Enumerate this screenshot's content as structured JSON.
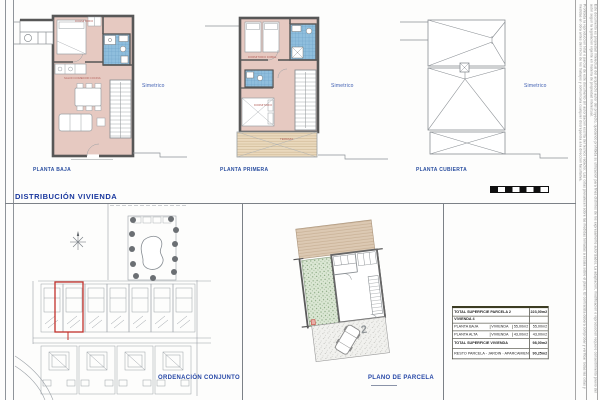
{
  "sheet": {
    "title": "DISTRIBUCIÓN  VIVIENDA",
    "plans": [
      {
        "label": "PLANTA BAJA",
        "note": "Simetrico"
      },
      {
        "label": "PLANTA PRIMERA",
        "note": "Simetrico"
      },
      {
        "label": "PLANTA CUBIERTA",
        "note": "Simetrico"
      }
    ],
    "room_labels": {
      "pb_bedroom": "DORMITORIO",
      "pb_living": "SALON COMEDOR COCINA",
      "p1_bedroom1": "DORMITORIO DOBLE",
      "p1_bedroom2": "DORMITORIO",
      "p1_terrace": "TERRAZA"
    },
    "panels": {
      "site_plan_label": "ORDENACIÓN CONJUNTO",
      "parcel_plan_label": "PLANO DE PARCELA",
      "parcel_number": "2"
    }
  },
  "table": {
    "rows": [
      {
        "label": "TOTAL SUPERFICIE  PARCELA 2",
        "value": "223,00m2"
      },
      {
        "label": "VIVIENDA 4",
        "value": ""
      },
      {
        "label": "PLANTA BAJA",
        "col2": "VIVIENDA",
        "col3": "55,00m2",
        "value": "55,00m2"
      },
      {
        "label": "PLANTA ALTA",
        "col2": "VIVIENDA",
        "col3": "43,00m2",
        "value": "43,00m2"
      },
      {
        "label": "TOTAL SUPERFICIE  VIVIENDA",
        "value": "98,00m2"
      },
      {
        "label": "RESTO PARCELA - JARDIN - APARCAMIENTO",
        "value": "90,25m2"
      }
    ]
  },
  "margin_notes": {
    "col1": "Prohibida la reproduccion total o parcial de este documento sin autorizacion escrita del tecnico redactor. Las cotas prevalecen sobre las medidas tomadas a escala sobre el plano. El contratista debera comprobar y verificar todas las cotas y medidas en obra antes del inicio de los trabajos y comunicara cualquier discrepancia a la direccion facultativa.",
    "col2": "Este documento es propiedad intelectual del arquitecto autor del proyecto, quedando prohibida su utilizacion para fines distintos de los expresamente autorizados. La adaptacion, modificacion o reproduccion requiere consentimiento previo del autor segun la legislacion vigente en materia de propiedad intelectual."
  },
  "colors": {
    "label_blue": "#2b4fa0",
    "room_pink": "#e6c9c1",
    "bath_tile_blue": "#8fbedd",
    "terrace_tan": "#ead9bd",
    "garden_green": "#dbe7d4",
    "highlight_red": "#c2302a",
    "wall_gray": "#575757"
  }
}
